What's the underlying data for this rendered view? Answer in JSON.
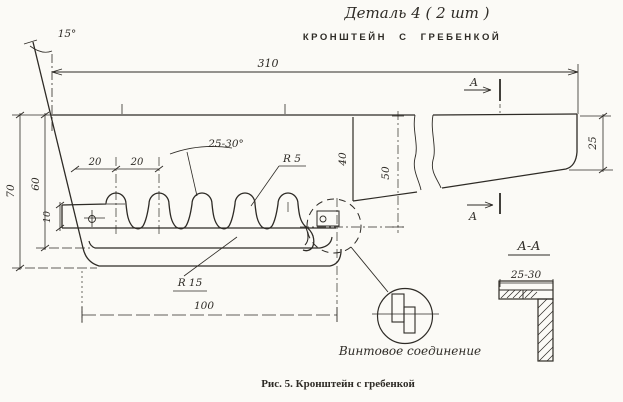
{
  "header": {
    "title_handwritten": "Деталь 4 ( 2 шт )",
    "subtitle_typed": "КРОНШТЕЙН С ГРЕБЕНКОЙ"
  },
  "caption": "Рис. 5. Кронштейн с гребенкой",
  "main_view": {
    "dim_overall_length": "310",
    "dim_left_angle": "15°",
    "dim_total_height": "70",
    "dim_comb_height": "60",
    "dim_tab_height": "10",
    "dim_pitch_1": "20",
    "dim_pitch_2": "20",
    "dim_slot_angle": "25-30°",
    "dim_tooth_radius": "R 5",
    "dim_step_height": "40",
    "dim_mid_height": "50",
    "dim_end_height": "25",
    "dim_base_radius": "R 15",
    "dim_comb_length": "100",
    "section_mark_top": "A",
    "section_mark_bottom": "A",
    "note_screw_joint": "Винтовое соединение"
  },
  "section_view": {
    "title": "А-А",
    "dim_width": "25-30"
  },
  "colors": {
    "ink": "#2e2b26",
    "paper": "#fbfaf6"
  }
}
